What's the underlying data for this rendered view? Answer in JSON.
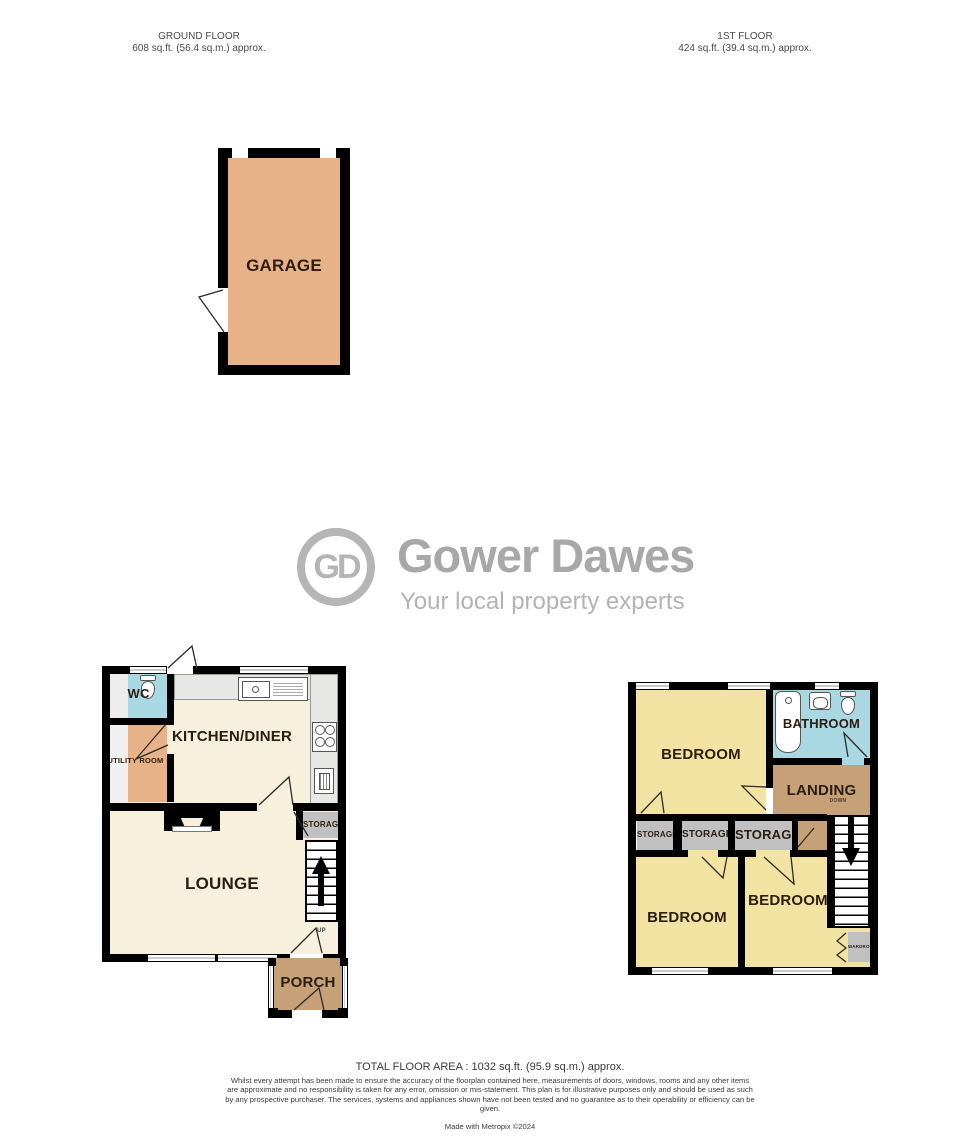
{
  "headers": {
    "ground_floor": {
      "title": "GROUND FLOOR",
      "area": "608 sq.ft. (56.4 sq.m.) approx."
    },
    "first_floor": {
      "title": "1ST FLOOR",
      "area": "424 sq.ft. (39.4 sq.m.) approx."
    }
  },
  "logo": {
    "monogram": "GD",
    "name": "Gower Dawes",
    "tagline": "Your local property experts"
  },
  "garage": {
    "label": "GARAGE"
  },
  "ground_floor": {
    "wc": "WC",
    "utility_room": "UTILITY ROOM",
    "kitchen_diner": "KITCHEN/DINER",
    "lounge": "LOUNGE",
    "storage": "STORAGE",
    "stairs_direction": "UP",
    "porch": "PORCH"
  },
  "first_floor": {
    "bedroom_front": "BEDROOM",
    "bathroom": "BATHROOM",
    "landing": "LANDING",
    "stairs_direction": "DOWN",
    "storage_left": "STORAGE",
    "storage_middle": "STORAGE",
    "storage_right": "STORAGE",
    "bedroom_back_left": "BEDROOM",
    "bedroom_back_right": "BEDROOM",
    "wardrobe": "WARDROBE"
  },
  "footer": {
    "total_area": "TOTAL FLOOR AREA : 1032 sq.ft. (95.9 sq.m.) approx.",
    "disclaimer": "Whilst every attempt has been made to ensure the accuracy of the floorplan contained here, measurements of doors, windows, rooms and any other items are approximate and no responsibility is taken for any error, omission or mis-statement. This plan is for illustrative purposes only and should be used as such by any prospective purchaser. The services, systems and appliances shown have not been tested and no guarantee as to their operability or efficiency can be given.",
    "credit": "Made with Metropix ©2024"
  },
  "colors": {
    "room_cream": "#f6f0dc",
    "room_yellow": "#f3e3a2",
    "room_blue": "#a9d7e2",
    "room_orange": "#e8b288",
    "room_brown": "#c6a177",
    "storage_gray": "#c0c0c0",
    "counter_gray": "#e7e7e5",
    "wall_black": "#000000",
    "logo_gray": "#b0b0b0"
  }
}
